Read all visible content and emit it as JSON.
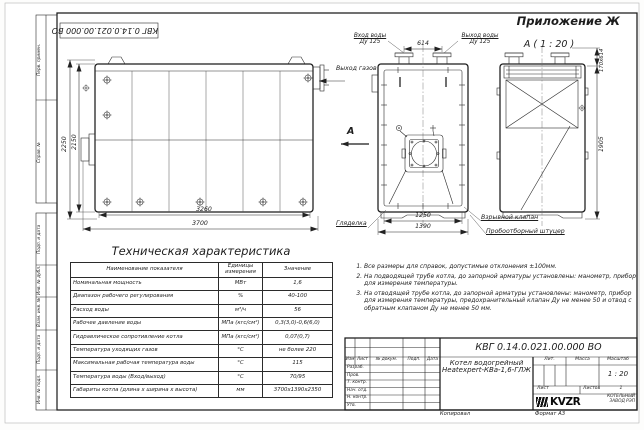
{
  "sheet": {
    "appendix": "Приложение Ж",
    "view_label": "А ( 1 : 20 )",
    "doc_number": "КВГ 0.14.0.021.00.000 ВО",
    "kopiroval": "Копировал",
    "format": "Формат А3"
  },
  "side_strip": {
    "items": [
      "Перв. примен.",
      "Справ. №",
      "Подп. и дата",
      "Инв. № дубл.",
      "Взам. инв. №",
      "Подп. и дата",
      "Инв. № подл."
    ]
  },
  "side_view": {
    "dim_height_outer": "2250",
    "dim_height_inner": "2150",
    "dim_width_inner": "3260",
    "dim_width_outer": "3700"
  },
  "front_view": {
    "water_inlet_label": "Вход воды",
    "water_inlet_dn": "Ду 125",
    "water_outlet_label": "Выход воды",
    "water_outlet_dn": "Ду 125",
    "dim_pipe_spacing": "614",
    "gas_outlet_label": "Выход газов",
    "view_arrow_letter": "А",
    "peephole_label": "Гляделка",
    "dim_width_inner": "1250",
    "dim_width_outer": "1390",
    "explosion_valve_label": "Взрывной клапан",
    "sampling_fitting_label": "Пробоотборный штуцер"
  },
  "right_view": {
    "dim_top": "170х614",
    "dim_height": "1905"
  },
  "spec_table": {
    "title": "Техническая характеристика",
    "headers": [
      "Наименование показателя",
      "Единицы измерения",
      "Значение"
    ],
    "rows": [
      [
        "Номинальная мощность",
        "МВт",
        "1,6"
      ],
      [
        "Диапазон рабочего регулирования",
        "%",
        "40-100"
      ],
      [
        "Расход воды",
        "м³/ч",
        "56"
      ],
      [
        "Рабочее давление воды",
        "МПа (кгс/см²)",
        "0,3(3,0)-0,6(6,0)"
      ],
      [
        "Гидравлическое сопротивление котла",
        "МПа (кгс/см²)",
        "0,07(0,7)"
      ],
      [
        "Температура уходящих газов",
        "°С",
        "не более 220"
      ],
      [
        "Максимальная рабочая температура воды",
        "°С",
        "115"
      ],
      [
        "Температура воды (Вход/выход)",
        "°С",
        "70/95"
      ],
      [
        "Габариты котла (длина х ширина х высота)",
        "мм",
        "3700х1390х2350"
      ]
    ]
  },
  "notes": [
    "Все размеры для справок, допустимые отклонения ±100мм.",
    "На подводящей трубе котла, до запорной арматуры установлены: манометр, прибор для измерения температуры.",
    "На отводящей трубе котла, до запорной арматуры установлены: манометр, прибор для измерения температуры, предохранительный клапан Ду не менее 50 и отвод с обратным клапаном Ду не менее 50 мм."
  ],
  "title_block": {
    "doc_number": "КВГ 0.14.0.021.00.000 ВО",
    "product_line1": "Котел водогрейный",
    "product_line2": "Heatexpert-КВа-1,6-ГЛЖ",
    "header_cols": [
      "Изм",
      "Лист",
      "№ докум.",
      "Подп.",
      "Дата"
    ],
    "sig_rows": [
      "Разраб.",
      "Пров.",
      "Т. контр.",
      "Нач. отд.",
      "Н. контр.",
      "Утв."
    ],
    "lit_label": "Лит.",
    "mass_label": "Масса",
    "scale_label": "Масштаб",
    "scale_value": "1 : 20",
    "sheet_label": "Лист",
    "sheets_label": "Листов",
    "sheets_value": "1",
    "logo_text": "KVZR",
    "company_line1": "КОТЕЛЬНЫЙ",
    "company_line2": "ЗАВОД РЭП"
  }
}
